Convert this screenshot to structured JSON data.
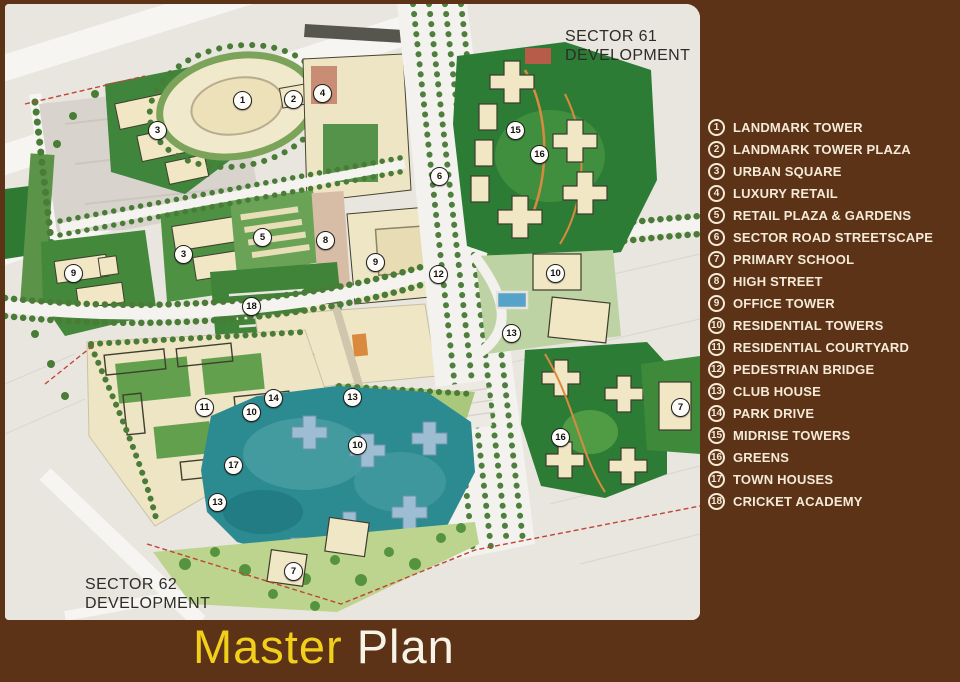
{
  "colors": {
    "panel_background": "#5c3317",
    "legend_text": "#f4ead8",
    "title_yellow": "#f2cf1b",
    "title_white": "#f8f3e7",
    "lake_teal": "#2c8b91",
    "park_green": "#2d7c36",
    "building_cream": "#efe6c6"
  },
  "map": {
    "sector_labels": [
      {
        "text": "SECTOR 61\nDEVELOPMENT",
        "x": 560,
        "y": 24
      },
      {
        "text": "SECTOR 62\nDEVELOPMENT",
        "x": 80,
        "y": 572
      }
    ],
    "markers": [
      {
        "n": "1",
        "x": 237,
        "y": 96
      },
      {
        "n": "2",
        "x": 288,
        "y": 95
      },
      {
        "n": "4",
        "x": 317,
        "y": 89
      },
      {
        "n": "3",
        "x": 152,
        "y": 126
      },
      {
        "n": "6",
        "x": 434,
        "y": 172
      },
      {
        "n": "15",
        "x": 510,
        "y": 126
      },
      {
        "n": "16",
        "x": 534,
        "y": 150
      },
      {
        "n": "3",
        "x": 178,
        "y": 250
      },
      {
        "n": "9",
        "x": 68,
        "y": 269
      },
      {
        "n": "5",
        "x": 257,
        "y": 233
      },
      {
        "n": "8",
        "x": 320,
        "y": 236
      },
      {
        "n": "9",
        "x": 370,
        "y": 258
      },
      {
        "n": "12",
        "x": 433,
        "y": 270
      },
      {
        "n": "18",
        "x": 246,
        "y": 302
      },
      {
        "n": "10",
        "x": 550,
        "y": 269
      },
      {
        "n": "13",
        "x": 506,
        "y": 329
      },
      {
        "n": "7",
        "x": 675,
        "y": 403
      },
      {
        "n": "16",
        "x": 555,
        "y": 433
      },
      {
        "n": "11",
        "x": 199,
        "y": 403
      },
      {
        "n": "14",
        "x": 268,
        "y": 394
      },
      {
        "n": "10",
        "x": 246,
        "y": 408
      },
      {
        "n": "13",
        "x": 347,
        "y": 393
      },
      {
        "n": "10",
        "x": 352,
        "y": 441
      },
      {
        "n": "17",
        "x": 228,
        "y": 461
      },
      {
        "n": "13",
        "x": 212,
        "y": 498
      },
      {
        "n": "7",
        "x": 288,
        "y": 567
      }
    ]
  },
  "legend": {
    "items": [
      {
        "number": "1",
        "label": "LANDMARK TOWER"
      },
      {
        "number": "2",
        "label": "LANDMARK TOWER PLAZA"
      },
      {
        "number": "3",
        "label": "URBAN SQUARE"
      },
      {
        "number": "4",
        "label": "LUXURY RETAIL"
      },
      {
        "number": "5",
        "label": "RETAIL PLAZA & GARDENS"
      },
      {
        "number": "6",
        "label": "SECTOR ROAD STREETSCAPE"
      },
      {
        "number": "7",
        "label": "PRIMARY SCHOOL"
      },
      {
        "number": "8",
        "label": "HIGH STREET"
      },
      {
        "number": "9",
        "label": "OFFICE TOWER"
      },
      {
        "number": "10",
        "label": "RESIDENTIAL TOWERS"
      },
      {
        "number": "11",
        "label": "RESIDENTIAL COURTYARD"
      },
      {
        "number": "12",
        "label": "PEDESTRIAN BRIDGE"
      },
      {
        "number": "13",
        "label": "CLUB HOUSE"
      },
      {
        "number": "14",
        "label": "PARK DRIVE"
      },
      {
        "number": "15",
        "label": "MIDRISE TOWERS"
      },
      {
        "number": "16",
        "label": "GREENS"
      },
      {
        "number": "17",
        "label": "TOWN HOUSES"
      },
      {
        "number": "18",
        "label": "CRICKET ACADEMY"
      }
    ]
  },
  "title": {
    "word1": "Master",
    "word2": "Plan"
  }
}
